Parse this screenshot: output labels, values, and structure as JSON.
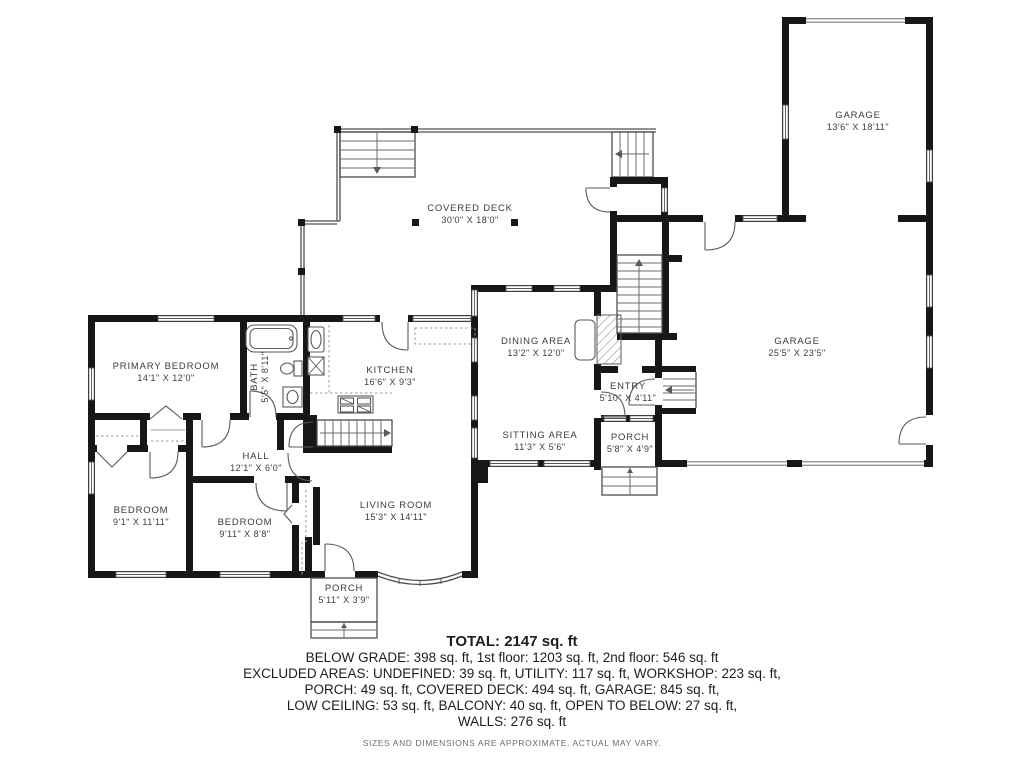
{
  "plan": {
    "colors": {
      "wall": "#171717",
      "thin_line": "#4d4d4d",
      "label": "#3b3b3b"
    },
    "rooms": {
      "garage_upper": {
        "name": "GARAGE",
        "dims": "13'6\" X 18'11\""
      },
      "covered_deck": {
        "name": "COVERED DECK",
        "dims": "30'0\" X 18'0\""
      },
      "primary_bedroom": {
        "name": "PRIMARY BEDROOM",
        "dims": "14'1\" X 12'0\""
      },
      "bath": {
        "name": "BATH",
        "dims": "5'5\" X 8'11\""
      },
      "kitchen": {
        "name": "KITCHEN",
        "dims": "16'6\" X 9'3\""
      },
      "dining_area": {
        "name": "DINING AREA",
        "dims": "13'2\" X 12'0\""
      },
      "sitting_area": {
        "name": "SITTING AREA",
        "dims": "11'3\" X 5'6\""
      },
      "entry": {
        "name": "ENTRY",
        "dims": "5'10\" X 4'11\""
      },
      "porch_entry": {
        "name": "PORCH",
        "dims": "5'8\" X 4'9\""
      },
      "garage_lower": {
        "name": "GARAGE",
        "dims": "25'5\" X 23'5\""
      },
      "hall": {
        "name": "HALL",
        "dims": "12'1\" X 6'0\""
      },
      "bedroom_left": {
        "name": "BEDROOM",
        "dims": "9'1\" X 11'11\""
      },
      "bedroom_middle": {
        "name": "BEDROOM",
        "dims": "9'11\" X 8'8\""
      },
      "living_room": {
        "name": "LIVING ROOM",
        "dims": "15'3\" X 14'11\""
      },
      "porch_front": {
        "name": "PORCH",
        "dims": "5'11\" X 3'9\""
      }
    }
  },
  "summary": {
    "total": "TOTAL: 2147 sq. ft",
    "line1": "BELOW GRADE: 398 sq. ft, 1st floor: 1203 sq. ft, 2nd floor: 546 sq. ft",
    "line2": "EXCLUDED AREAS: UNDEFINED: 39 sq. ft, UTILITY: 117 sq. ft, WORKSHOP: 223 sq. ft,",
    "line3": "PORCH: 49 sq. ft, COVERED DECK: 494 sq. ft, GARAGE: 845 sq. ft,",
    "line4": "LOW CEILING: 53 sq. ft, BALCONY: 40 sq. ft, OPEN TO BELOW: 27 sq. ft,",
    "line5": "WALLS: 276 sq. ft",
    "disclaimer": "SIZES AND DIMENSIONS ARE APPROXIMATE. ACTUAL MAY VARY."
  }
}
